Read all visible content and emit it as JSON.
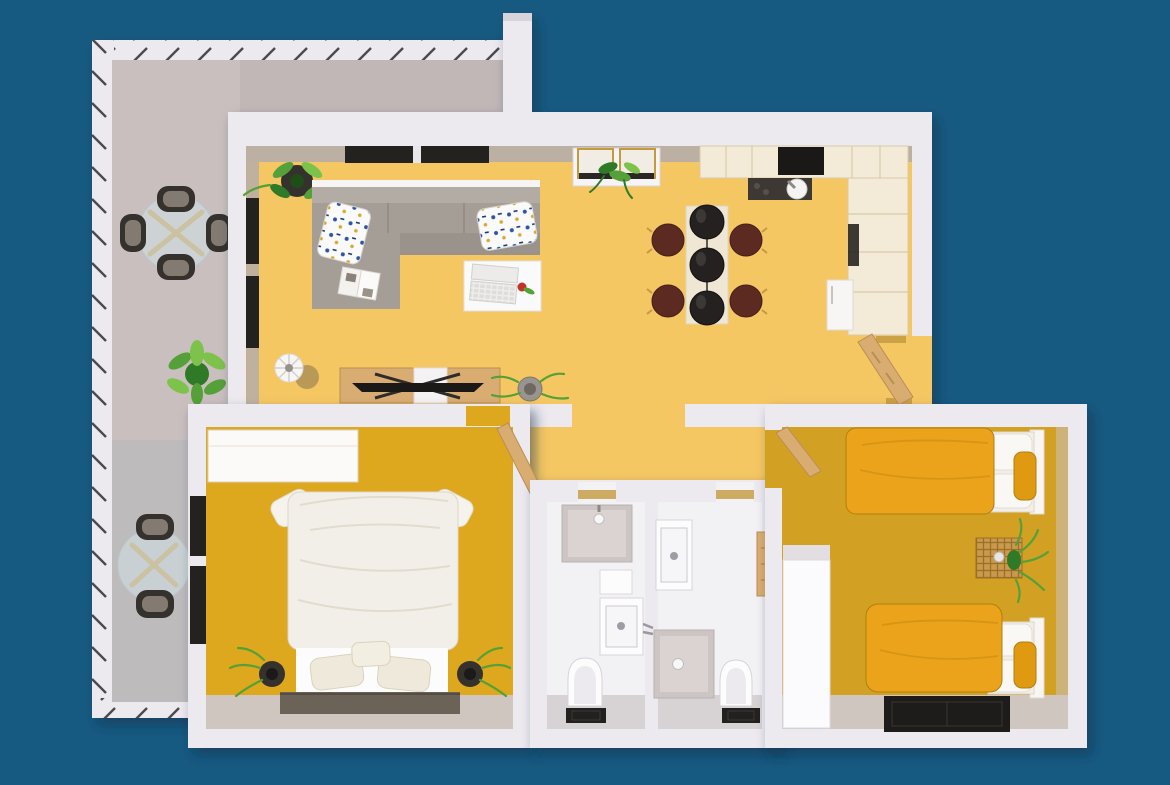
{
  "scene": {
    "type": "3d-apartment-floor-plan-render",
    "view": "top-down",
    "background": "#175A81",
    "visible_text": "none"
  },
  "colors": {
    "bg": "#175A81",
    "wall": "#ECE9EF",
    "wallCap": "#D8D4DC",
    "wallFace": "#B5ADA8",
    "lowerFace": "#CEC6BF",
    "livingFloor": "#F5C763",
    "b1Floor": "#DDA71E",
    "b2Floor": "#D2A124",
    "balconyFloor": "#C9BFBF",
    "balconyFloorTop": "#C1B7B7",
    "bathFloor": "#F2F1F4",
    "bathLower": "#D7D2D4",
    "cabinetCream": "#F3EAD8",
    "cabinetLine": "#D9CBA9",
    "counterDark": "#3D3834",
    "nearBlack": "#1B1918",
    "tableCream": "#EFE7D3",
    "chairMaroon": "#5C2A21",
    "maroonDark": "#451F18",
    "wood": "#D9AD72",
    "woodDark": "#B98F52",
    "gold": "#C49A3F",
    "duvetOrange": "#EAA31A",
    "duvetFold": "#C8890F",
    "bedWhite": "#F2EFE8",
    "pureWhite": "#FCFCFC",
    "showerGray": "#CDC5C3",
    "showerInner": "#DAD3D1",
    "matDark": "#23211F",
    "windowDark": "#24221F",
    "sofaGray": "#A59E97",
    "sofaBack": "#B3ACA5",
    "sofaSeat": "#9A938C",
    "platformDark": "#6B6258",
    "rugDark": "#1E1C1B",
    "plantGreen": "#55A038",
    "plantGreenDark": "#2F7A26",
    "plantGreenLight": "#7CC24B",
    "potDark": "#35312D",
    "rattan": "#C9994D",
    "glassTint": "rgba(208,226,230,0.55)",
    "fridgeWhite": "#F7F6F4",
    "flowerRed": "#C13326"
  },
  "rooms": [
    {
      "id": "balcony",
      "floor": "gray",
      "items": [
        "round-glass-table-with-4-chairs",
        "potted-plant",
        "round-glass-table-with-2-chairs",
        "glass-railing"
      ]
    },
    {
      "id": "living-dining-kitchen",
      "floor": "light-yellow",
      "items": [
        "l-shaped-gray-sofa",
        "two-patterned-pillows",
        "open-magazine",
        "white-coffee-table",
        "laptop",
        "red-flower",
        "tv-sideboard",
        "flat-tv",
        "striped-vase",
        "fern-plant",
        "corner-plant",
        "study-desk",
        "two-gold-frame-chairs",
        "desk-plant",
        "dining-table",
        "four-maroon-chairs",
        "three-black-pendant-lamps",
        "upper-cabinets",
        "black-cooktop",
        "dark-counter-with-sink",
        "side-counter",
        "fridge",
        "open-entry-door"
      ]
    },
    {
      "id": "bedroom-1",
      "floor": "mustard",
      "items": [
        "double-bed-white-duvet",
        "three-pillows",
        "two-corner-pillows",
        "dark-bed-platform",
        "white-wardrobe",
        "two-potted-ferns",
        "left-wall-windows",
        "open-door"
      ]
    },
    {
      "id": "bathroom-1",
      "floor": "white",
      "items": [
        "shower-tray",
        "wall-shelf",
        "vanity-sink",
        "toilet",
        "dark-mat"
      ]
    },
    {
      "id": "bathroom-2",
      "floor": "white",
      "items": [
        "vanity-sink",
        "shower-tray",
        "toilet",
        "dark-mat",
        "wood-wall-cabinet"
      ]
    },
    {
      "id": "bedroom-2",
      "floor": "mustard",
      "items": [
        "single-bed-orange-duvet-top",
        "single-bed-orange-duvet-bottom",
        "rattan-side-table",
        "fern-plant",
        "white-wardrobe",
        "dark-rug",
        "open-door"
      ]
    }
  ]
}
